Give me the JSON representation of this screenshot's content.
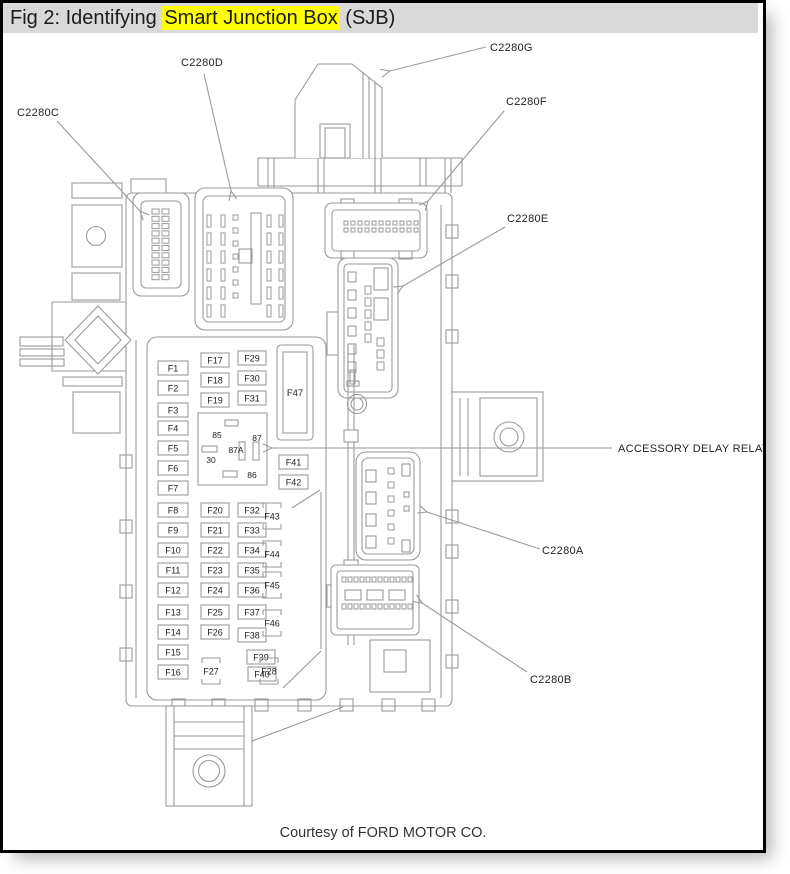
{
  "title": {
    "prefix": "Fig 2: Identifying ",
    "highlight": "Smart Junction Box",
    "suffix": " (SJB)"
  },
  "footer": {
    "credit": "Courtesy of FORD MOTOR CO."
  },
  "colors": {
    "line": "#9a9a9a",
    "label_text": "#222222",
    "titlebar_bg": "#d9d9d9",
    "highlight": "#ffff00",
    "border": "#000000"
  },
  "diagram": {
    "callouts": [
      {
        "id": "c2280c",
        "label": "C2280C",
        "tx": 17,
        "ty": 116,
        "pts": [
          [
            57,
            121
          ],
          [
            140,
            211
          ]
        ]
      },
      {
        "id": "c2280d",
        "label": "C2280D",
        "tx": 181,
        "ty": 66,
        "pts": [
          [
            204,
            74
          ],
          [
            231,
            191
          ]
        ]
      },
      {
        "id": "c2280g",
        "label": "C2280G",
        "tx": 490,
        "ty": 51,
        "pts": [
          [
            486,
            47
          ],
          [
            390,
            71
          ]
        ]
      },
      {
        "id": "c2280f",
        "label": "C2280F",
        "tx": 506,
        "ty": 105,
        "pts": [
          [
            504,
            111
          ],
          [
            428,
            201
          ]
        ]
      },
      {
        "id": "c2280e",
        "label": "C2280E",
        "tx": 507,
        "ty": 222,
        "pts": [
          [
            505,
            227
          ],
          [
            403,
            286
          ]
        ]
      },
      {
        "id": "accessory-delay-relay",
        "label": "ACCESSORY DELAY RELAY",
        "tx": 618,
        "ty": 452,
        "pts": [
          [
            612,
            448
          ],
          [
            272,
            448
          ]
        ]
      },
      {
        "id": "c2280a",
        "label": "C2280A",
        "tx": 542,
        "ty": 554,
        "pts": [
          [
            540,
            549
          ],
          [
            427,
            512
          ]
        ]
      },
      {
        "id": "c2280b",
        "label": "C2280B",
        "tx": 530,
        "ty": 683,
        "pts": [
          [
            527,
            672
          ],
          [
            422,
            603
          ]
        ]
      }
    ],
    "fuse_boxes": [
      {
        "label": "F1",
        "x": 158,
        "cy": 368,
        "w": 30
      },
      {
        "label": "F2",
        "x": 158,
        "cy": 388,
        "w": 30
      },
      {
        "label": "F3",
        "x": 158,
        "cy": 410,
        "w": 30
      },
      {
        "label": "F4",
        "x": 158,
        "cy": 428,
        "w": 30
      },
      {
        "label": "F5",
        "x": 158,
        "cy": 448,
        "w": 30
      },
      {
        "label": "F6",
        "x": 158,
        "cy": 468,
        "w": 30
      },
      {
        "label": "F7",
        "x": 158,
        "cy": 488,
        "w": 30
      },
      {
        "label": "F8",
        "x": 158,
        "cy": 510,
        "w": 30
      },
      {
        "label": "F9",
        "x": 158,
        "cy": 530,
        "w": 30
      },
      {
        "label": "F10",
        "x": 158,
        "cy": 550,
        "w": 30
      },
      {
        "label": "F11",
        "x": 158,
        "cy": 570,
        "w": 30
      },
      {
        "label": "F12",
        "x": 158,
        "cy": 590,
        "w": 30
      },
      {
        "label": "F13",
        "x": 158,
        "cy": 612,
        "w": 30
      },
      {
        "label": "F14",
        "x": 158,
        "cy": 632,
        "w": 30
      },
      {
        "label": "F15",
        "x": 158,
        "cy": 652,
        "w": 30
      },
      {
        "label": "F16",
        "x": 158,
        "cy": 672,
        "w": 30
      },
      {
        "label": "F17",
        "x": 201,
        "cy": 360,
        "w": 28
      },
      {
        "label": "F18",
        "x": 201,
        "cy": 380,
        "w": 28
      },
      {
        "label": "F19",
        "x": 201,
        "cy": 400,
        "w": 28
      },
      {
        "label": "F20",
        "x": 201,
        "cy": 510,
        "w": 28
      },
      {
        "label": "F21",
        "x": 201,
        "cy": 530,
        "w": 28
      },
      {
        "label": "F22",
        "x": 201,
        "cy": 550,
        "w": 28
      },
      {
        "label": "F23",
        "x": 201,
        "cy": 570,
        "w": 28
      },
      {
        "label": "F24",
        "x": 201,
        "cy": 590,
        "w": 28
      },
      {
        "label": "F25",
        "x": 201,
        "cy": 612,
        "w": 28
      },
      {
        "label": "F26",
        "x": 201,
        "cy": 632,
        "w": 28
      },
      {
        "label": "F29",
        "x": 238,
        "cy": 358,
        "w": 28
      },
      {
        "label": "F30",
        "x": 238,
        "cy": 378,
        "w": 28
      },
      {
        "label": "F31",
        "x": 238,
        "cy": 398,
        "w": 28
      },
      {
        "label": "F32",
        "x": 238,
        "cy": 510,
        "w": 28
      },
      {
        "label": "F33",
        "x": 238,
        "cy": 530,
        "w": 28
      },
      {
        "label": "F34",
        "x": 238,
        "cy": 550,
        "w": 28
      },
      {
        "label": "F35",
        "x": 238,
        "cy": 570,
        "w": 28
      },
      {
        "label": "F36",
        "x": 238,
        "cy": 590,
        "w": 28
      },
      {
        "label": "F37",
        "x": 238,
        "cy": 612,
        "w": 28
      },
      {
        "label": "F38",
        "x": 238,
        "cy": 635,
        "w": 28
      },
      {
        "label": "F39",
        "x": 247,
        "cy": 657,
        "w": 28
      },
      {
        "label": "F40",
        "x": 248,
        "cy": 674,
        "w": 28
      },
      {
        "label": "F41",
        "x": 279,
        "cy": 462,
        "w": 29
      },
      {
        "label": "F42",
        "x": 279,
        "cy": 482,
        "w": 29
      }
    ],
    "fuse_marks": [
      {
        "label": "F43",
        "cx": 272,
        "cy": 516
      },
      {
        "label": "F44",
        "cx": 272,
        "cy": 554
      },
      {
        "label": "F45",
        "cx": 272,
        "cy": 585
      },
      {
        "label": "F46",
        "cx": 272,
        "cy": 623
      },
      {
        "label": "F27",
        "cx": 211,
        "cy": 671
      },
      {
        "label": "F28",
        "cx": 269,
        "cy": 671
      }
    ],
    "panel_labels": [
      {
        "t": "F47",
        "x": 295,
        "y": 396,
        "fs": 9.5
      },
      {
        "t": "85",
        "x": 217,
        "y": 438,
        "fs": 8.5
      },
      {
        "t": "87",
        "x": 257,
        "y": 441,
        "fs": 8.5
      },
      {
        "t": "87A",
        "x": 236,
        "y": 453,
        "fs": 8.5
      },
      {
        "t": "30",
        "x": 211,
        "y": 463,
        "fs": 8.5
      },
      {
        "t": "86",
        "x": 252,
        "y": 478,
        "fs": 8.5
      }
    ]
  }
}
